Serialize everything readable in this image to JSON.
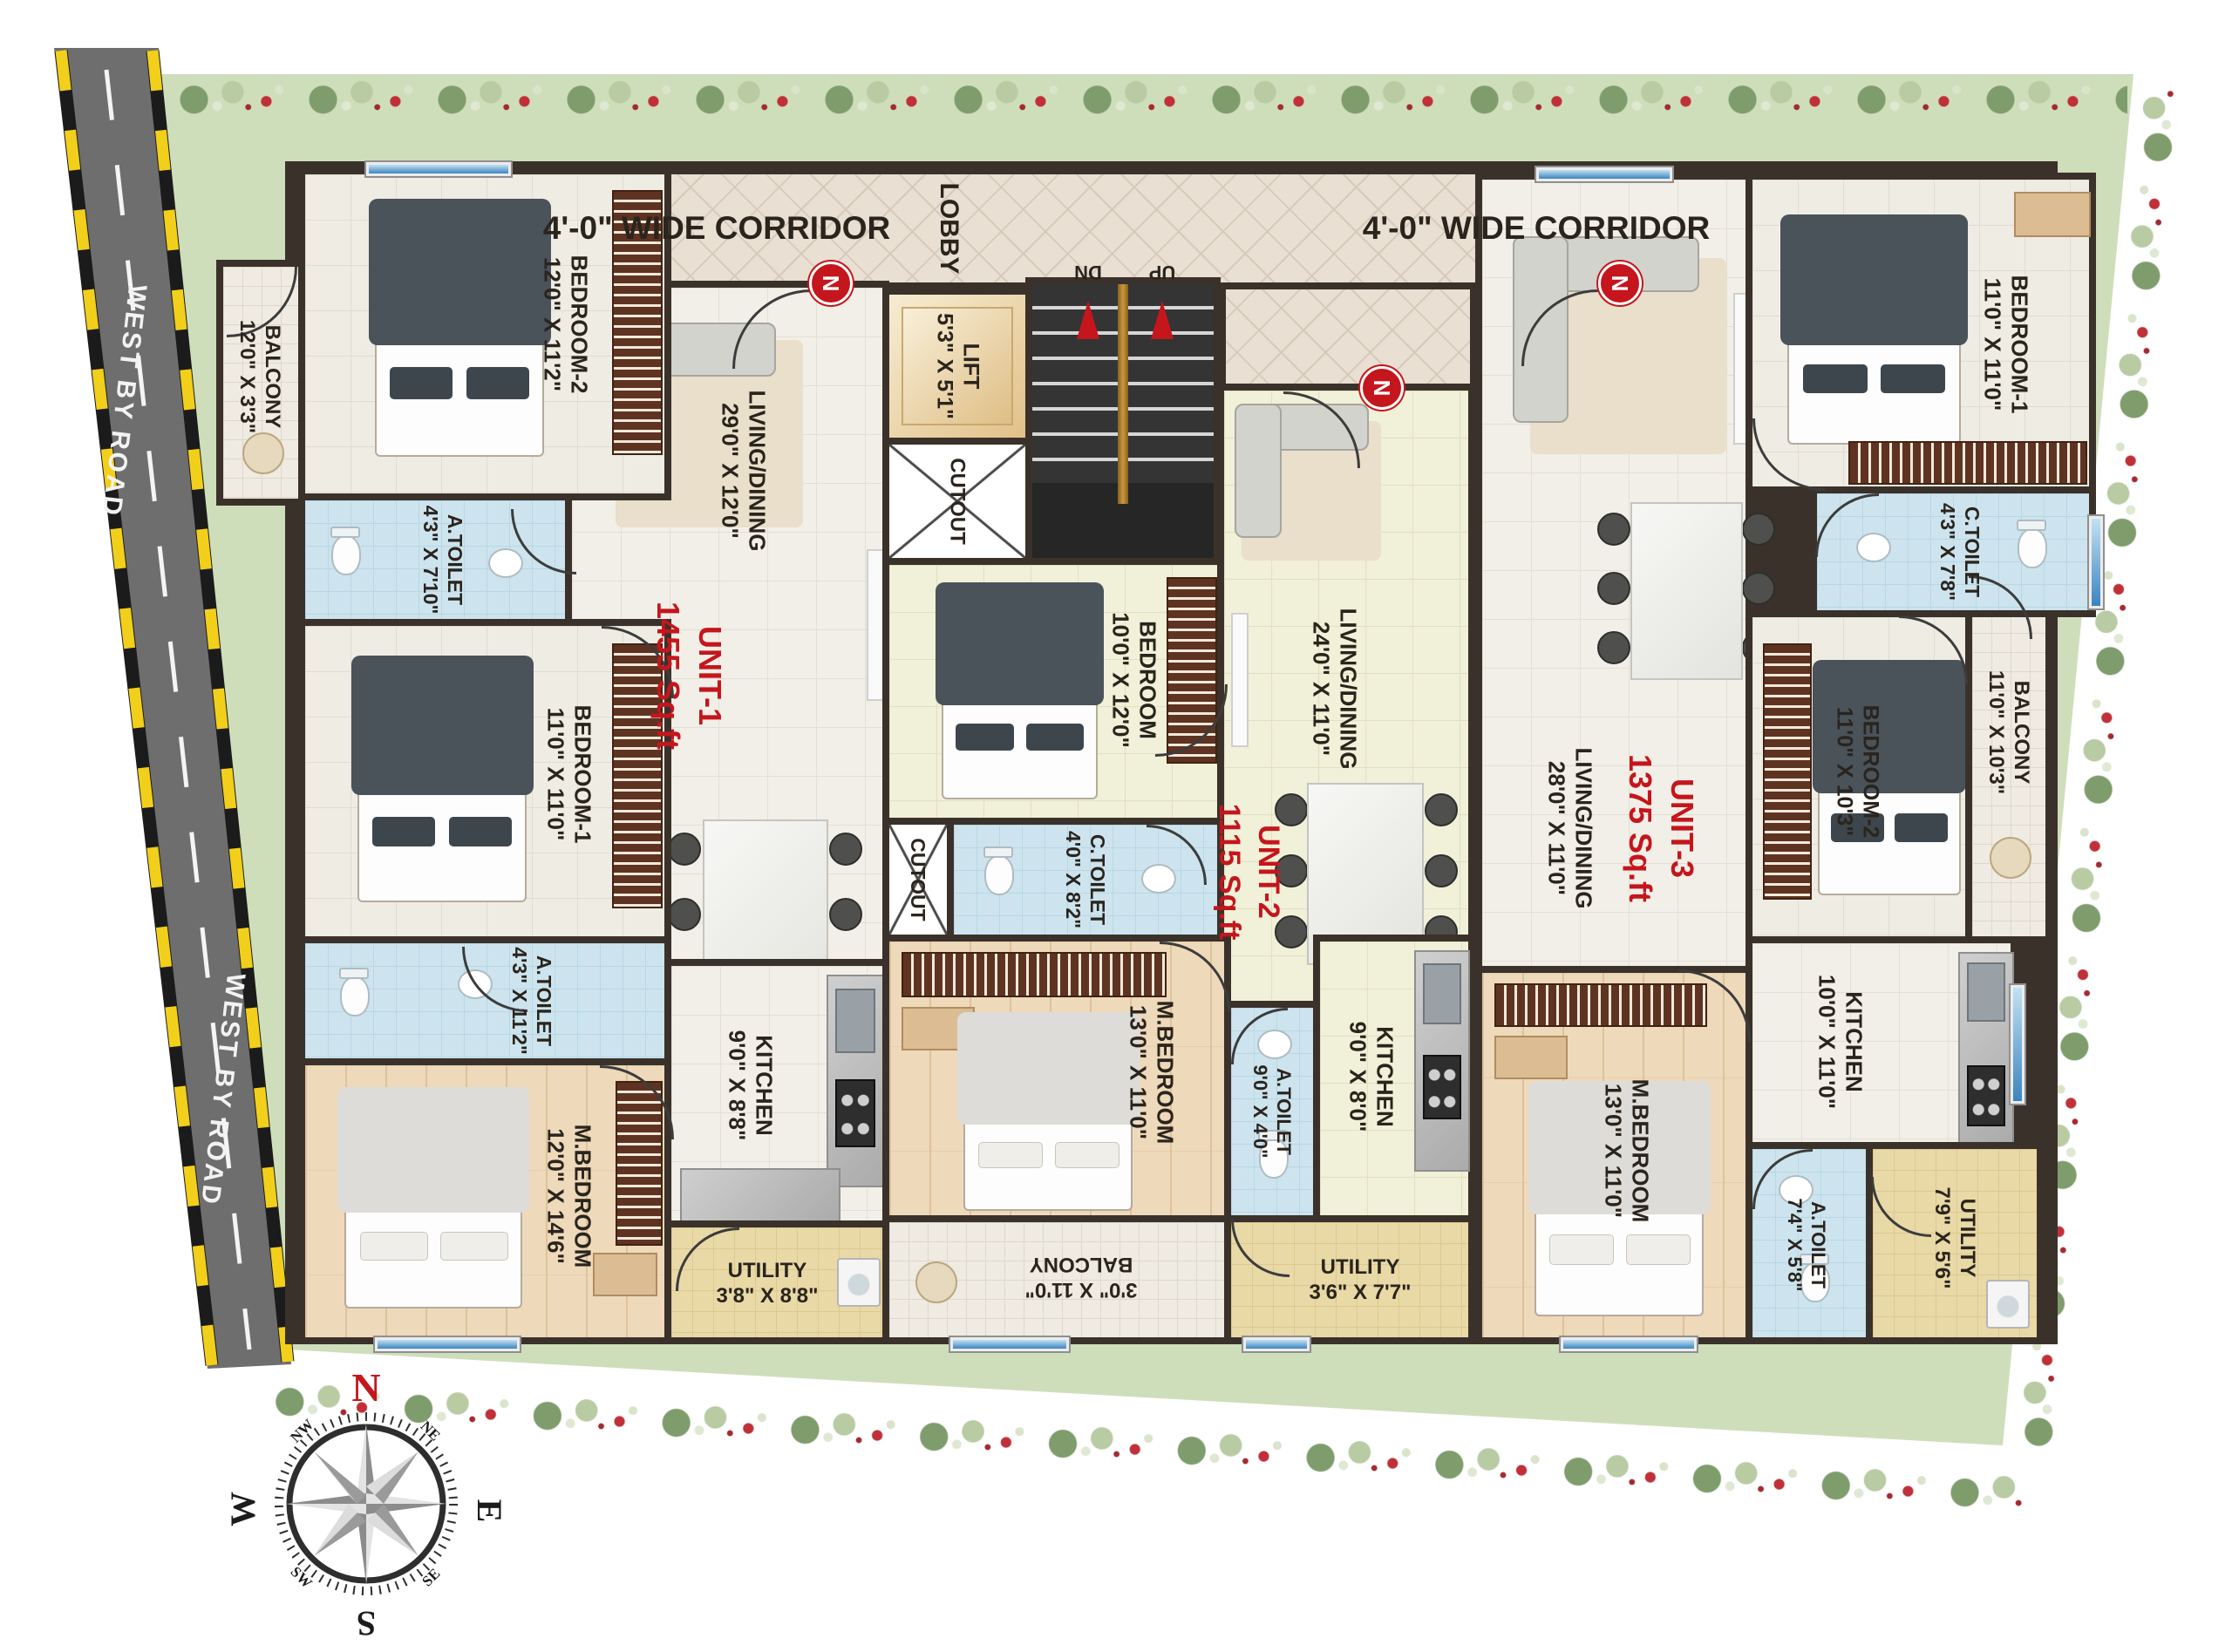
{
  "colors": {
    "accent_red": "#c4161c",
    "wall_dark": "#3a322a",
    "site_green": "#cfdeba",
    "road_gray": "#6f6f6f",
    "toilet_blue": "#cde4ee",
    "utility_yellow": "#e9d9a7",
    "window_blue": "#3c85c0",
    "lift_beige": "#eed9ae",
    "rail_gold": "#c89a3f"
  },
  "site": {
    "road_label_top": "WEST BY ROAD",
    "road_label_bottom": "WEST BY ROAD"
  },
  "compass": {
    "n": "N",
    "e": "E",
    "s": "S",
    "w": "W",
    "ne": "NE",
    "nw": "NW",
    "se": "SE",
    "sw": "SW"
  },
  "common": {
    "corridor_left": "4'-0\" WIDE CORRIDOR",
    "corridor_right": "4'-0\" WIDE CORRIDOR",
    "lobby": "LOBBY",
    "lift_name": "LIFT",
    "lift_dims": "5'3\" X 5'1\"",
    "cutout_a": "CUTOUT",
    "cutout_b": "CUTOUT",
    "up": "UP",
    "dn": "DN",
    "door_marker": "N"
  },
  "unit1": {
    "label": "UNIT-1",
    "area": "1455 Sq.ft",
    "rooms": {
      "balcony": {
        "name": "BALCONY",
        "dims": "12'0\" X 3'3\""
      },
      "bedroom2": {
        "name": "BEDROOM-2",
        "dims": "12'0\" X 11'2\""
      },
      "atoilet_top": {
        "name": "A.TOILET",
        "dims": "4'3\" X 7'10\""
      },
      "bedroom1": {
        "name": "BEDROOM-1",
        "dims": "11'0\" X 11'0\""
      },
      "atoilet_mid": {
        "name": "A.TOILET",
        "dims": "4'3\" X 11'2\""
      },
      "living": {
        "name": "LIVING/DINING",
        "dims": "29'0\" X 12'0\""
      },
      "mbedroom": {
        "name": "M.BEDROOM",
        "dims": "12'0\" X 14'6\""
      },
      "kitchen": {
        "name": "KITCHEN",
        "dims": "9'0\" X 8'8\""
      },
      "utility": {
        "name": "UTILITY",
        "dims": "3'8\" X 8'8\""
      }
    }
  },
  "unit2": {
    "label": "UNIT-2",
    "area": "1115 Sq.ft",
    "rooms": {
      "bedroom": {
        "name": "BEDROOM",
        "dims": "10'0\" X 12'0\""
      },
      "ctoilet": {
        "name": "C.TOILET",
        "dims": "4'0\" X 8'2\""
      },
      "living": {
        "name": "LIVING/DINING",
        "dims": "24'0\" X 11'0\""
      },
      "mbedroom": {
        "name": "M.BEDROOM",
        "dims": "13'0\" X 11'0\""
      },
      "atoilet": {
        "name": "A.TOILET",
        "dims": "9'0\" X 4'0\""
      },
      "kitchen": {
        "name": "KITCHEN",
        "dims": "9'0\" X 8'0\""
      },
      "utility": {
        "name": "UTILITY",
        "dims": "3'6\" X 7'7\""
      },
      "balcony": {
        "name": "BALCONY",
        "dims": "3'0\" X 11'0\""
      }
    }
  },
  "unit3": {
    "label": "UNIT-3",
    "area": "1375 Sq.ft",
    "rooms": {
      "bedroom1": {
        "name": "BEDROOM-1",
        "dims": "11'0\" X 11'0\""
      },
      "ctoilet": {
        "name": "C.TOILET",
        "dims": "4'3\" X 7'8\""
      },
      "bedroom2": {
        "name": "BEDROOM-2",
        "dims": "11'0\" X 10'3\""
      },
      "balcony": {
        "name": "BALCONY",
        "dims": "11'0\" X 10'3\""
      },
      "living": {
        "name": "LIVING/DINING",
        "dims": "28'0\" X 11'0\""
      },
      "kitchen": {
        "name": "KITCHEN",
        "dims": "10'0\" X 11'0\""
      },
      "mbedroom": {
        "name": "M.BEDROOM",
        "dims": "13'0\" X 11'0\""
      },
      "atoilet": {
        "name": "A.TOILET",
        "dims": "7'4\" X 5'8\""
      },
      "utility": {
        "name": "UTILITY",
        "dims": "7'9\" X 5'6\""
      }
    }
  }
}
